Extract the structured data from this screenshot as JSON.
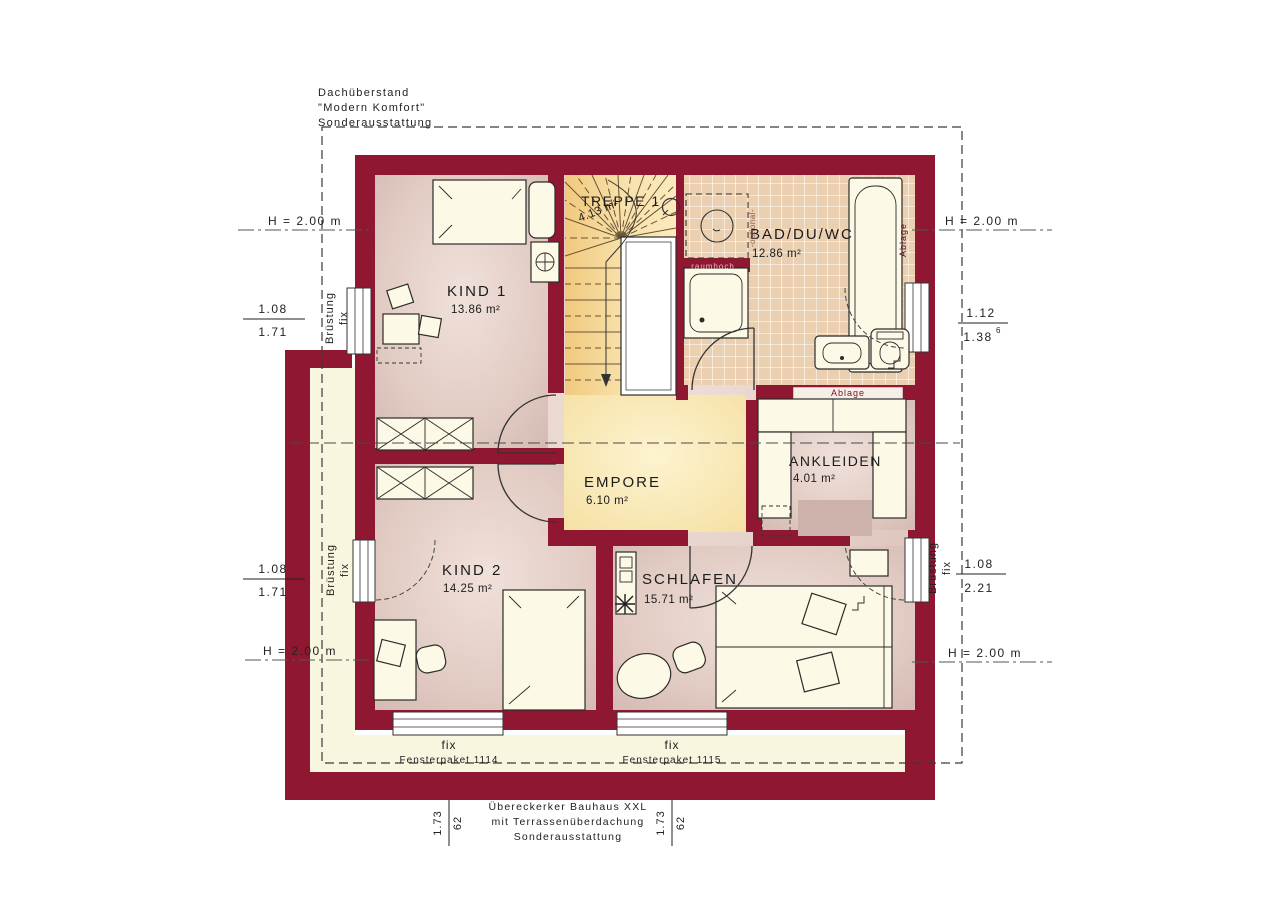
{
  "annotations": {
    "roof_overhang": {
      "line1": "Dachüberstand",
      "line2": "\"Modern Komfort\"",
      "line3": "Sonderausstattung"
    },
    "bottom": {
      "line1": "Übereckerker Bauhaus XXL",
      "line2": "mit Terrassenüberdachung",
      "line3": "Sonderausstattung"
    }
  },
  "rooms": {
    "treppe": {
      "name": "TREPPE 1",
      "area": "4.13 m²"
    },
    "bad": {
      "name": "BAD/DU/WC",
      "area": "12.86 m²"
    },
    "kind1": {
      "name": "KIND 1",
      "area": "13.86 m²"
    },
    "empore": {
      "name": "EMPORE",
      "area": "6.10 m²"
    },
    "ankleiden": {
      "name": "ANKLEIDEN",
      "area": "4.01 m²"
    },
    "kind2": {
      "name": "KIND 2",
      "area": "14.25 m²"
    },
    "schlafen": {
      "name": "SCHLAFEN",
      "area": "15.71 m²"
    }
  },
  "dimensions": {
    "h_top_left": "H = 2.00 m",
    "h_top_right": "H = 2.00 m",
    "h_bottom_left": "H = 2.00 m",
    "h_bottom_right": "H = 2.00 m",
    "left_top": {
      "num": "1.08",
      "den": "1.71"
    },
    "left_bottom": {
      "num": "1.08",
      "den": "1.71"
    },
    "right_top": {
      "num": "1.12",
      "den": "1.38",
      "sup": "6"
    },
    "right_bottom": {
      "num": "1.08",
      "den": "2.21"
    },
    "bottom_left_pair": {
      "a": "1.73",
      "b": "62"
    },
    "bottom_right_pair": {
      "a": "1.73",
      "b": "62"
    },
    "bruestung_line1": "Brüstung",
    "bruestung_line2": "fix"
  },
  "windows": {
    "package1": {
      "fix": "fix",
      "label": "Fensterpaket 1114"
    },
    "package2": {
      "fix": "fix",
      "label": "Fensterpaket 1115"
    }
  },
  "wall_labels": {
    "ablage_shelf": "Ablage",
    "ablage_tub": "Ablage",
    "raumhoch": "raumhoch",
    "optional": "-optional-"
  },
  "colors": {
    "wall": "#901731",
    "floor_edge": "#d5bbb3",
    "floor_center": "#efe0da",
    "empore": "#f9e9b8",
    "stair": "#f4d38a",
    "tile": "#ebcfb1",
    "furniture": "#fcf9e6",
    "terrace_band": "#f9f6df"
  }
}
